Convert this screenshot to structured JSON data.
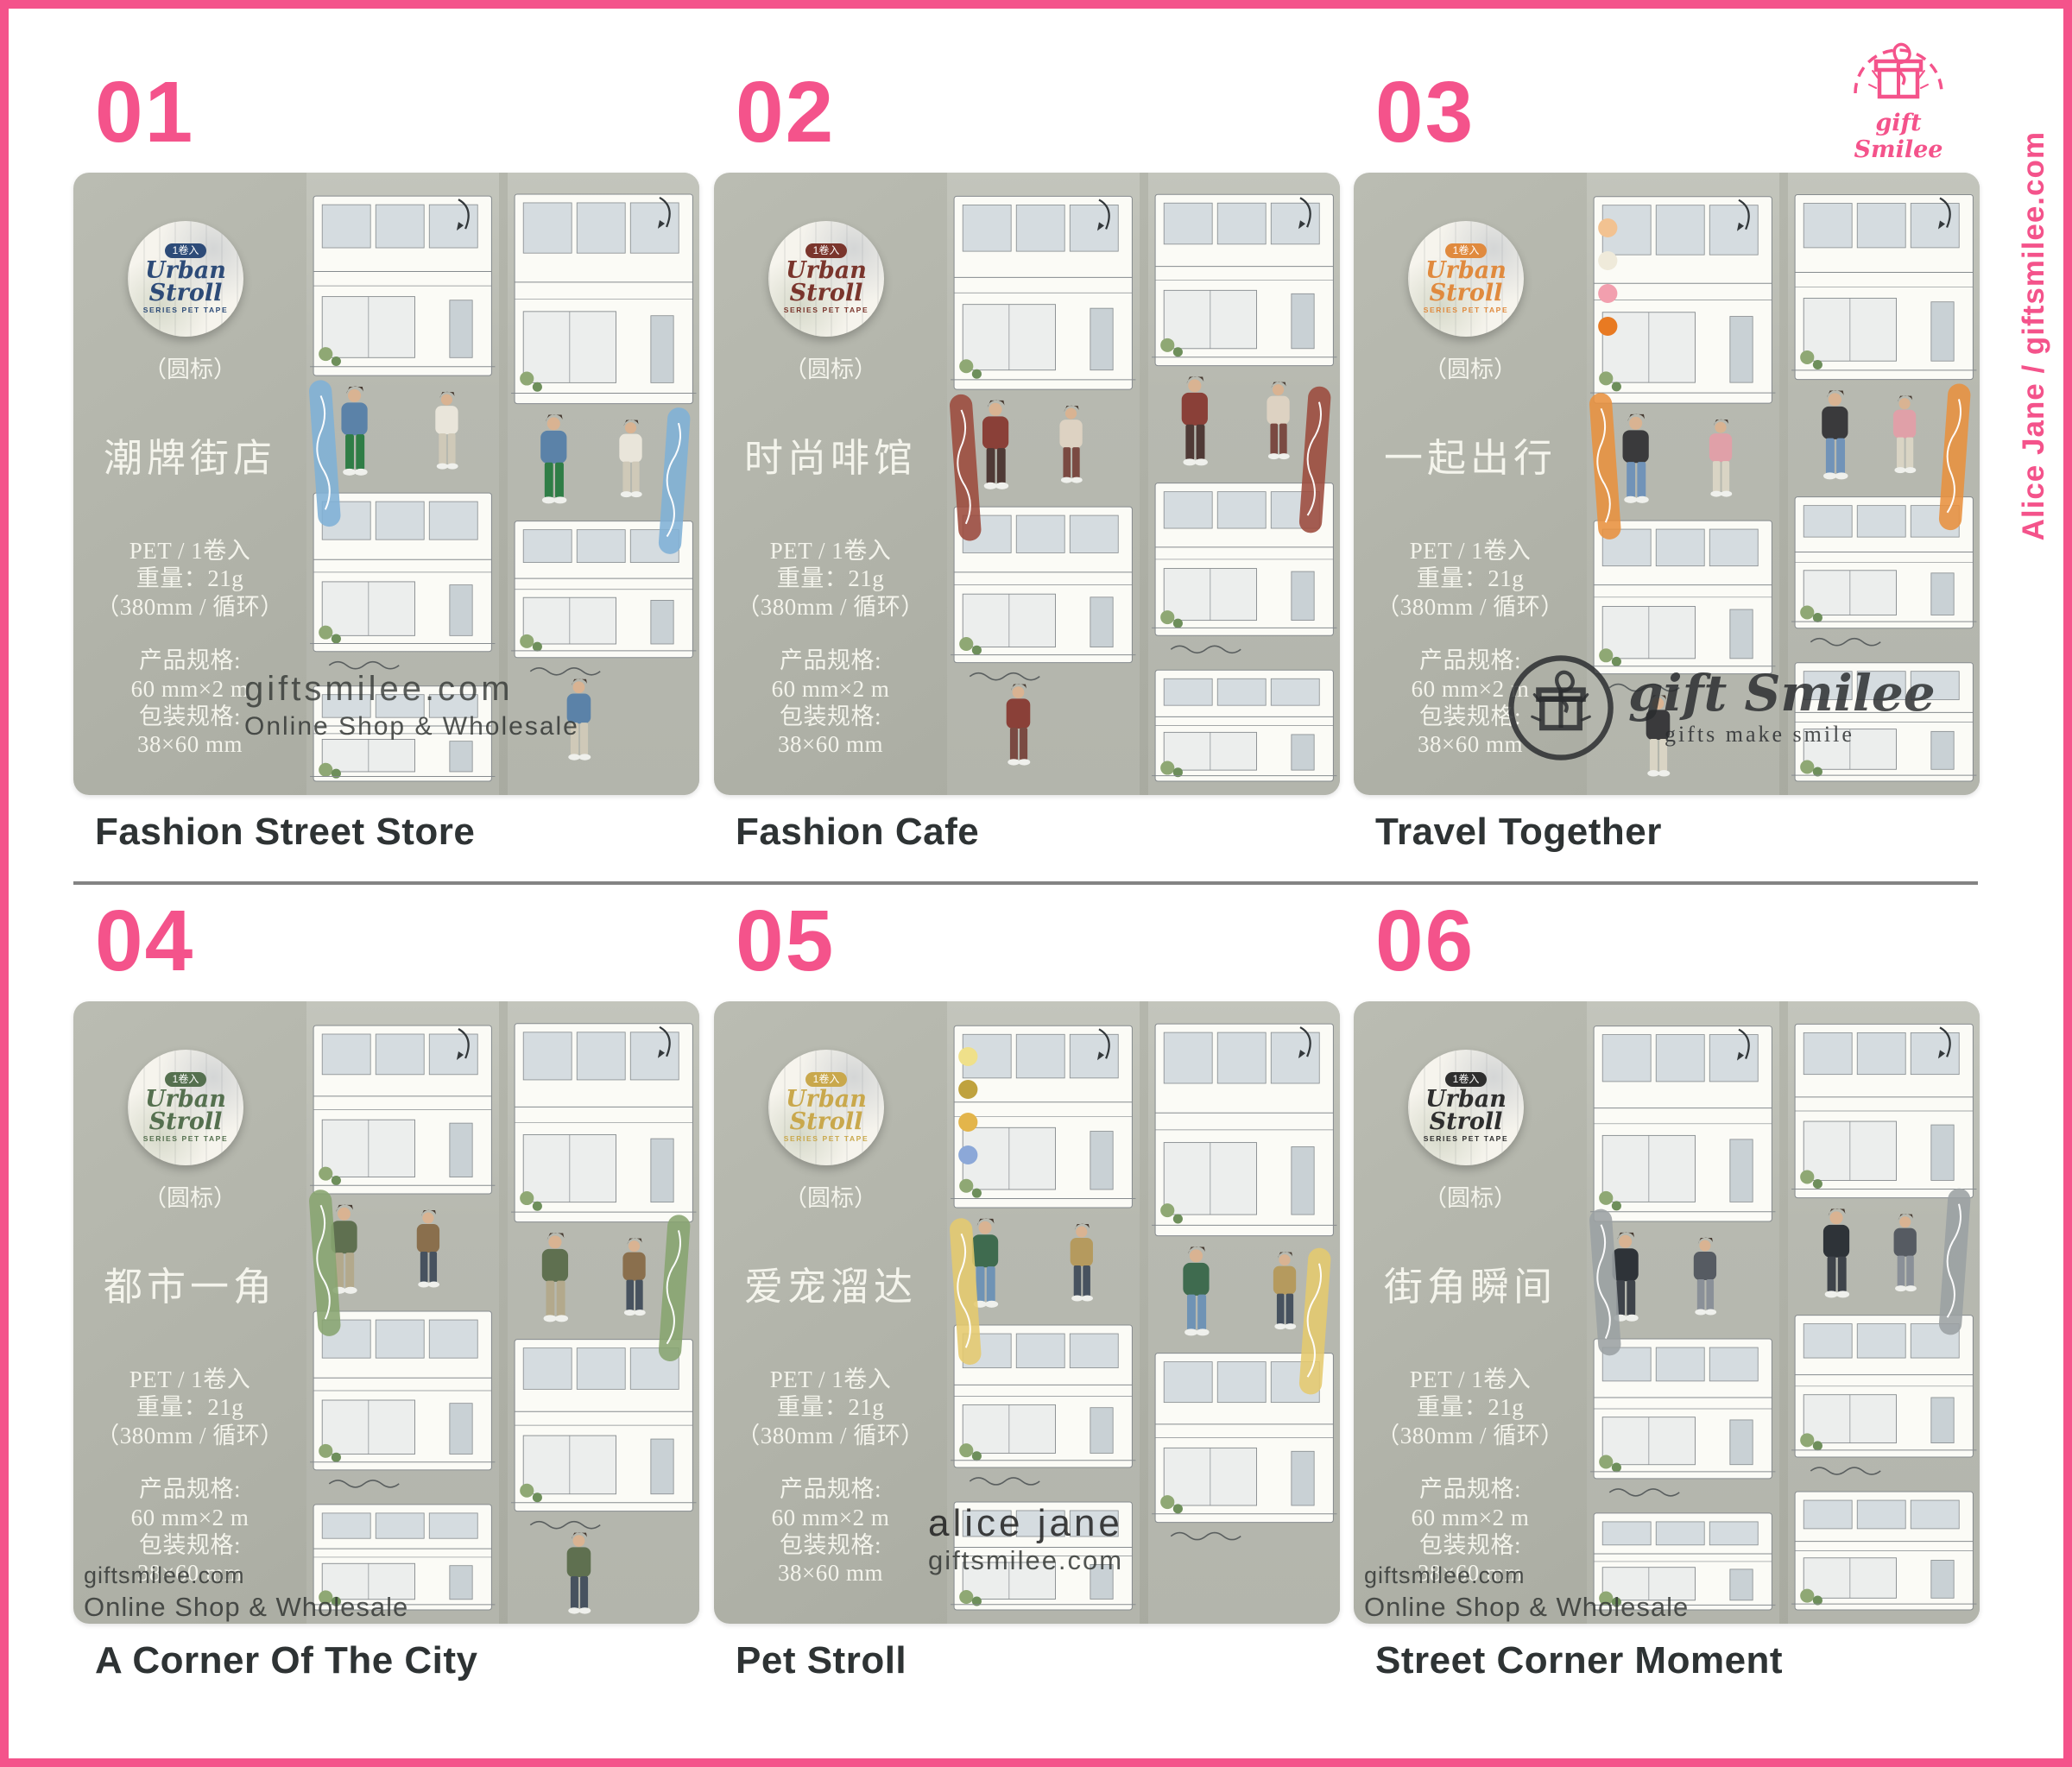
{
  "brand": {
    "logo_text": "gift Smilee",
    "side_credit": "Alice Jane / giftsmilee.com"
  },
  "watermarks": {
    "site": "giftsmilee.com",
    "online": "Online Shop & Wholesale",
    "alice": "alice jane",
    "logo_text": "gift Smilee",
    "logo_tagline": "gifts make smile"
  },
  "badge": {
    "count_label": "1卷入",
    "series_line1": "Urban",
    "series_line2": "Stroll",
    "series_sub": "SERIES PET TAPE"
  },
  "round_label": "（圆标）",
  "specs": [
    "PET / 1卷入",
    "重量：21g",
    "（380mm / 循环）",
    "产品规格:",
    "60 mm×2 m",
    "包装规格:",
    "38×60 mm"
  ],
  "colors": {
    "accent_pink": "#F4538B",
    "card_bg": "#B0B2A8",
    "strip_bg": "#BBBDB4",
    "caption_text": "#2E3334",
    "divider_gray": "#838383"
  },
  "cards": [
    {
      "number": "01",
      "title_cn": "潮牌街店",
      "title_en": "Fashion Street Store",
      "accent": "#7FB0D6",
      "badge_color": "#2D4B78",
      "watermark": "site-mid"
    },
    {
      "number": "02",
      "title_cn": "时尚啡馆",
      "title_en": "Fashion Cafe",
      "accent": "#9C4A3C",
      "badge_color": "#7A352C",
      "watermark": "none"
    },
    {
      "number": "03",
      "title_cn": "一起出行",
      "title_en": "Travel Together",
      "accent": "#E8913F",
      "badge_color": "#E08A3E",
      "watermark": "logo",
      "dots": [
        "#F2C291",
        "#EFEADA",
        "#F29FAE",
        "#E87A22"
      ]
    },
    {
      "number": "04",
      "title_cn": "都市一角",
      "title_en": "A Corner Of The City",
      "accent": "#87A46F",
      "badge_color": "#55704F",
      "watermark": "site-bottom"
    },
    {
      "number": "05",
      "title_cn": "爱宠溜达",
      "title_en": "Pet Stroll",
      "accent": "#E5C96E",
      "badge_color": "#C9A84C",
      "watermark": "alice",
      "dots": [
        "#EFE08A",
        "#BFA23E",
        "#E3B54B",
        "#8CA8D8"
      ]
    },
    {
      "number": "06",
      "title_cn": "街角瞬间",
      "title_en": "Street Corner Moment",
      "accent": "#9BA1A3",
      "badge_color": "#2E2E2E",
      "watermark": "site-bottom"
    }
  ]
}
